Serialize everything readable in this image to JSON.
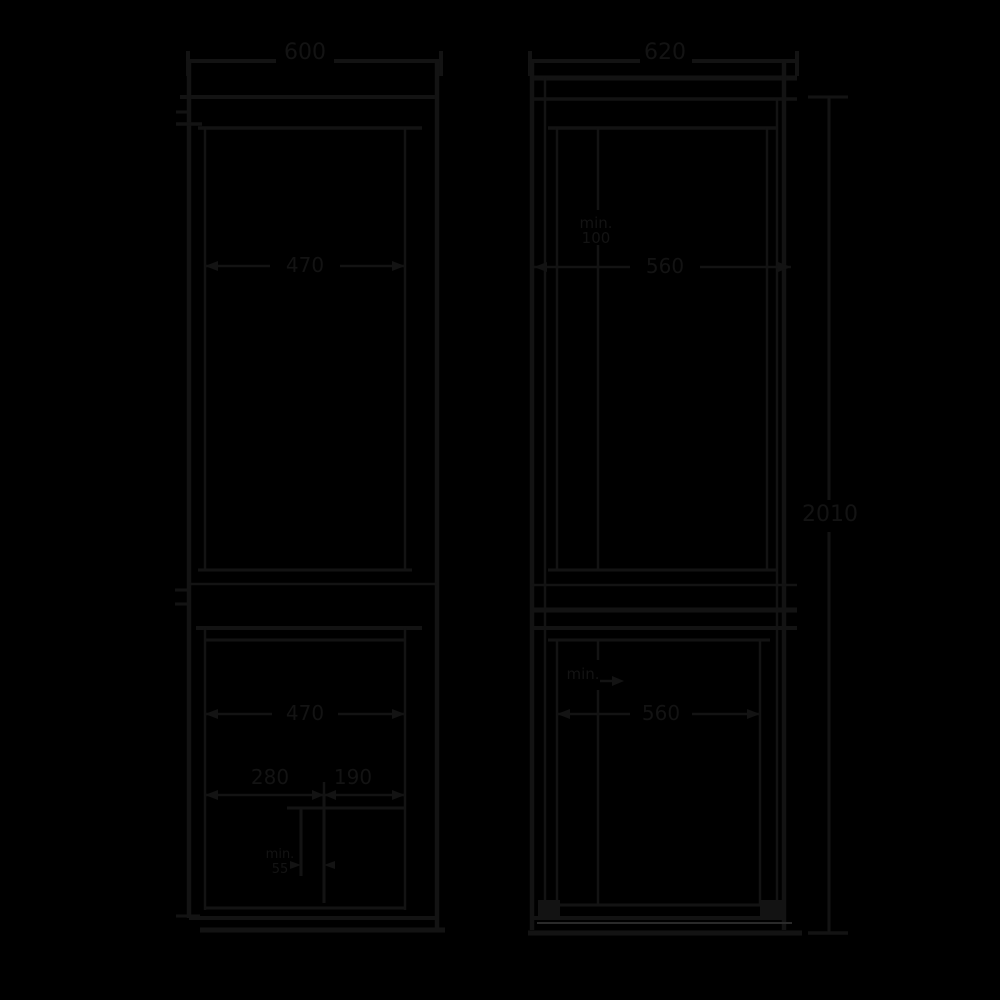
{
  "canvas": {
    "background_color": "#000000",
    "line_color": "#131313",
    "light_line_color": "#2a2a2a",
    "text_color": "#131313"
  },
  "front_view": {
    "overall_width": "600",
    "upper_door_width": "470",
    "freezer_door_width": "470",
    "lower_left_width": "280",
    "lower_right_width": "190",
    "foot_detail_line1": "min.",
    "foot_detail_line2": "55"
  },
  "side_view": {
    "overall_depth": "620",
    "overall_height": "2010",
    "upper_clearance_line1": "min.",
    "upper_clearance_line2": "100",
    "body_depth": "560",
    "freezer_depth": "560",
    "freezer_note": "min."
  }
}
